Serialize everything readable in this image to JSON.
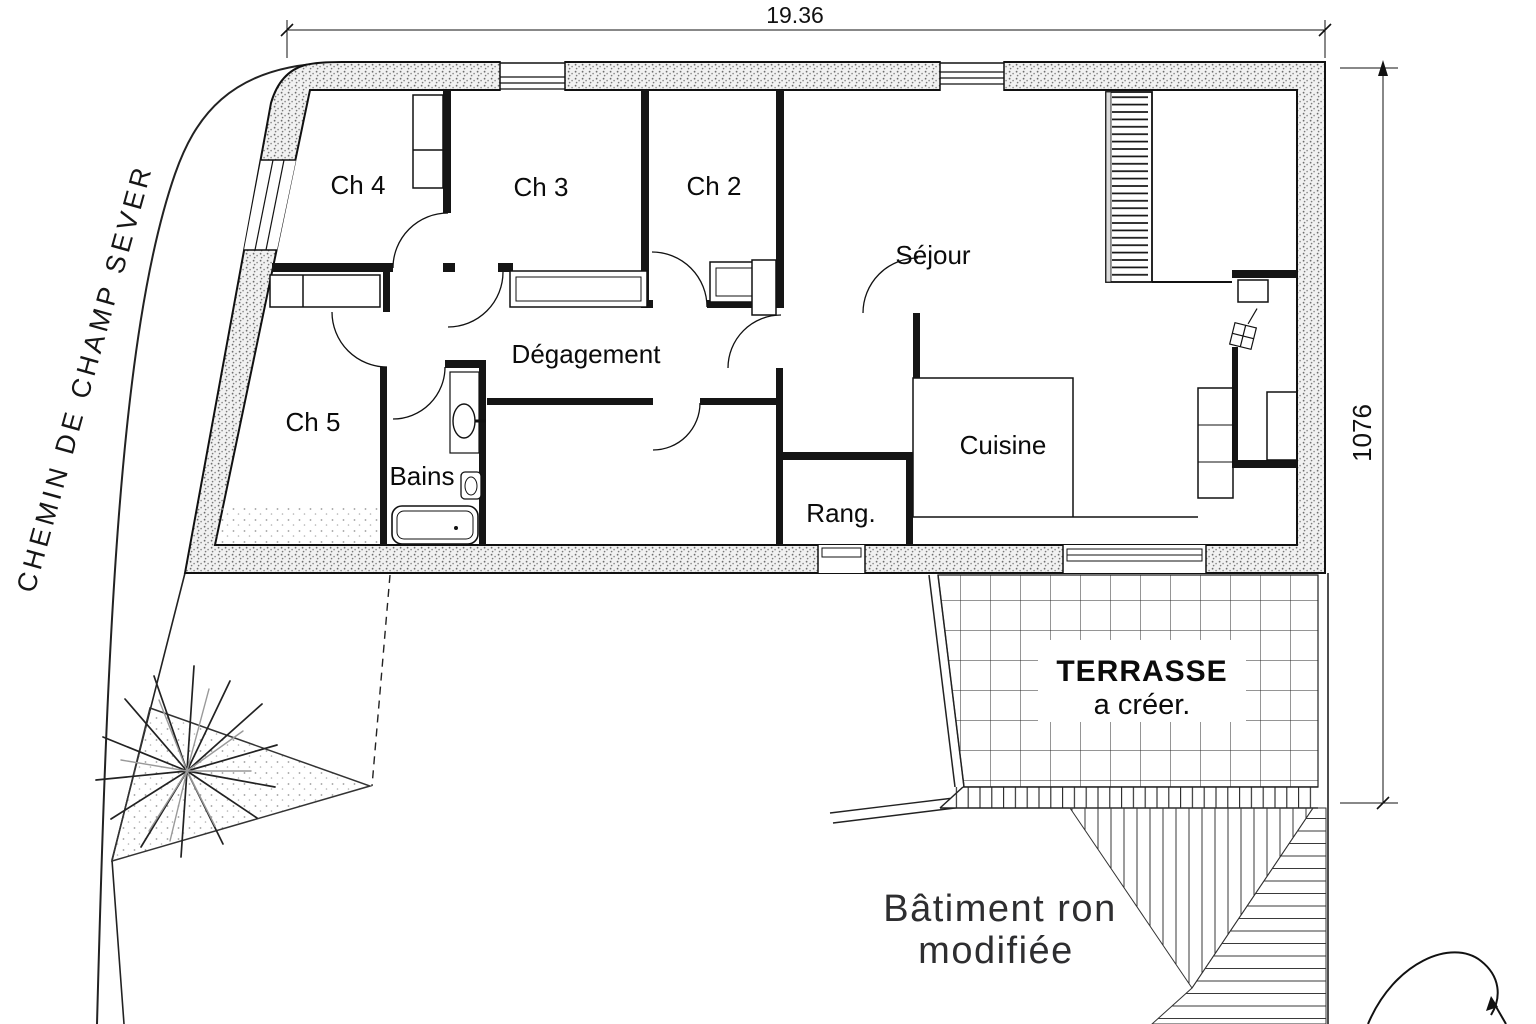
{
  "street": {
    "label": "CHEMIN DE CHAMP SEVER"
  },
  "dimensions": {
    "width_label": "19.36",
    "height_label": "1076"
  },
  "rooms": {
    "ch4": "Ch 4",
    "ch3": "Ch 3",
    "ch2": "Ch 2",
    "ch5": "Ch 5",
    "sejour": "Séjour",
    "degagement": "Dégagement",
    "bains": "Bains",
    "rang": "Rang.",
    "cuisine": "Cuisine"
  },
  "terrace": {
    "title": "TERRASSE",
    "subtitle": "a créer."
  },
  "note": {
    "line1": "Bâtiment ron",
    "line2": "modifiée"
  },
  "colors": {
    "ink": "#111111",
    "wall_fill": "#f1f1f1",
    "wall_dot": "#6e6e6e",
    "paper": "#ffffff"
  }
}
